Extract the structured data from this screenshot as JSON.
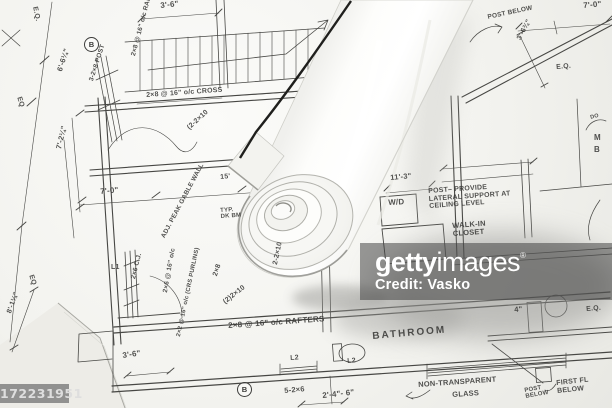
{
  "watermark": {
    "brand_bold": "getty",
    "brand_light": "images",
    "registered": "®",
    "credit": "Credit: Vasko"
  },
  "id_badge": {
    "text": "172231951"
  },
  "colors": {
    "paper": "#f4f4f0",
    "ink": "#3c3c3c",
    "roll_paper": "#fdfdfb",
    "shadow": "#8d8d8a",
    "watermark_bg": "rgba(62,62,62,0.52)"
  },
  "plan": {
    "annotations": [
      {
        "t": "E.Q.",
        "x": 38,
        "y": 6,
        "r": 78,
        "s": 7
      },
      {
        "t": "3'-6\"",
        "x": 160,
        "y": 2,
        "r": -6,
        "s": 8
      },
      {
        "t": "POST BELOW",
        "x": 487,
        "y": 14,
        "r": -12,
        "s": 6.5
      },
      {
        "t": "7'-0\"",
        "x": 583,
        "y": 2,
        "r": -5,
        "s": 8
      },
      {
        "t": "3'-6¾\"",
        "x": 516,
        "y": 38,
        "r": -62,
        "s": 7
      },
      {
        "t": "E.Q.",
        "x": 556,
        "y": 64,
        "r": -5,
        "s": 7
      },
      {
        "t": "6'-6¼\"",
        "x": 56,
        "y": 70,
        "r": -72,
        "s": 7.5
      },
      {
        "t": "3-2×8 POST",
        "x": 88,
        "y": 80,
        "r": -72,
        "s": 6.5
      },
      {
        "t": "2×8 @ 16\" o/c RAF.",
        "x": 130,
        "y": 55,
        "r": -75,
        "s": 6.5
      },
      {
        "t": "2×8 @ 16\" o/c CROSS",
        "x": 146,
        "y": 92,
        "r": -4,
        "s": 7
      },
      {
        "t": "(2-2×10",
        "x": 186,
        "y": 126,
        "r": -42,
        "s": 7
      },
      {
        "t": "EQ",
        "x": 22,
        "y": 96,
        "r": 72,
        "s": 7
      },
      {
        "t": "7'-2¼\"",
        "x": 55,
        "y": 148,
        "r": -76,
        "s": 7.5
      },
      {
        "t": "15'",
        "x": 220,
        "y": 174,
        "r": -5,
        "s": 7
      },
      {
        "t": "7'-0\"",
        "x": 100,
        "y": 188,
        "r": -5,
        "s": 8
      },
      {
        "t": "ADJ. PEAK GABLE WALL",
        "x": 160,
        "y": 236,
        "r": -62,
        "s": 6.5
      },
      {
        "t": "TYP. DK BM",
        "x": 220,
        "y": 208,
        "r": -4,
        "s": 6,
        "w": 24
      },
      {
        "t": "2×8",
        "x": 212,
        "y": 275,
        "r": -72,
        "s": 7
      },
      {
        "t": "2-2×10",
        "x": 272,
        "y": 264,
        "r": -78,
        "s": 7
      },
      {
        "t": "(2)2×10",
        "x": 222,
        "y": 300,
        "r": -38,
        "s": 7
      },
      {
        "t": "L1",
        "x": 111,
        "y": 264,
        "r": 0,
        "s": 7
      },
      {
        "t": "2×6 C.J.",
        "x": 130,
        "y": 278,
        "r": -76,
        "s": 6.5
      },
      {
        "t": "EQ",
        "x": 34,
        "y": 274,
        "r": 72,
        "s": 7
      },
      {
        "t": "8'-1¼\"",
        "x": 6,
        "y": 312,
        "r": -70,
        "s": 7
      },
      {
        "t": "2×6 @ 16\" o/c",
        "x": 162,
        "y": 292,
        "r": -80,
        "s": 6.5
      },
      {
        "t": "2×2 @ 16\" o/c (CRS PURLINS)",
        "x": 176,
        "y": 336,
        "r": -78,
        "s": 6
      },
      {
        "t": "3'-6\"",
        "x": 122,
        "y": 352,
        "r": -8,
        "s": 8
      },
      {
        "t": "2×8 @ 16\" o/c RAFTERS",
        "x": 228,
        "y": 322,
        "r": -4,
        "s": 8
      },
      {
        "t": "L2",
        "x": 290,
        "y": 355,
        "r": -4,
        "s": 7
      },
      {
        "t": "L2",
        "x": 347,
        "y": 358,
        "r": -4,
        "s": 7
      },
      {
        "t": "5-2×6",
        "x": 284,
        "y": 387,
        "r": -5,
        "s": 7.5
      },
      {
        "t": "BATHROOM",
        "x": 372,
        "y": 332,
        "r": -5,
        "s": 10,
        "sp": 2
      },
      {
        "t": "NON-TRANSPARENT",
        "x": 418,
        "y": 381,
        "r": -4,
        "s": 7.5
      },
      {
        "t": "GLASS",
        "x": 452,
        "y": 391,
        "r": -4,
        "s": 7.5
      },
      {
        "t": "2'-4\"- 6\"",
        "x": 322,
        "y": 392,
        "r": -6,
        "s": 8
      },
      {
        "t": "4\"",
        "x": 514,
        "y": 306,
        "r": -5,
        "s": 7.5
      },
      {
        "t": "E.Q.",
        "x": 586,
        "y": 306,
        "r": -5,
        "s": 7
      },
      {
        "t": "11'-3\"",
        "x": 390,
        "y": 174,
        "r": -5,
        "s": 7.5
      },
      {
        "t": "W/D",
        "x": 388,
        "y": 199,
        "r": -3,
        "s": 8
      },
      {
        "t": "POST– PROVIDE LATERAL SUPPORT AT CEILING LEVEL",
        "x": 428,
        "y": 188,
        "r": -4,
        "s": 7,
        "w": 90
      },
      {
        "t": "WALK-IN CLOSET",
        "x": 452,
        "y": 222,
        "r": -4,
        "s": 7.5,
        "w": 50
      },
      {
        "t": "M",
        "x": 594,
        "y": 134,
        "r": 0,
        "s": 8
      },
      {
        "t": "B",
        "x": 594,
        "y": 146,
        "r": 0,
        "s": 8
      },
      {
        "t": "DO",
        "x": 590,
        "y": 116,
        "r": -15,
        "s": 5.5
      },
      {
        "t": "FIRST FL BELOW",
        "x": 556,
        "y": 380,
        "r": -6,
        "s": 7,
        "w": 48
      },
      {
        "t": "POST BELOW",
        "x": 524,
        "y": 388,
        "r": -10,
        "s": 6,
        "w": 28
      }
    ],
    "markers": [
      {
        "t": "B",
        "x": 84,
        "y": 37
      },
      {
        "t": "B",
        "x": 237,
        "y": 382
      }
    ]
  }
}
